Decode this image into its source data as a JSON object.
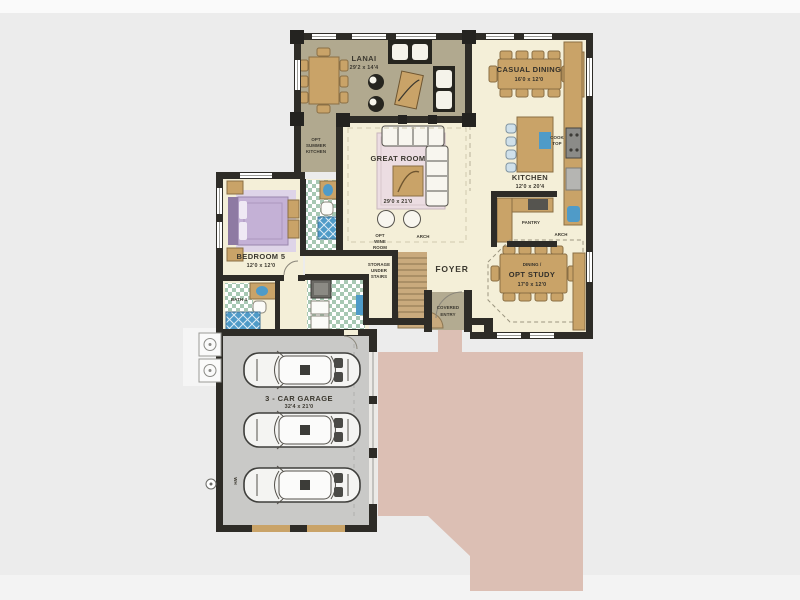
{
  "plan_title": "Single-story home floor plan",
  "rooms": {
    "lanai": {
      "name": "LANAI",
      "dims": "29'2 x 14'4"
    },
    "casual_dining": {
      "name": "CASUAL DINING",
      "dims": "16'0 x 12'0"
    },
    "kitchen": {
      "name": "KITCHEN",
      "dims": "12'0 x 20'4"
    },
    "great_room": {
      "name": "GREAT ROOM",
      "dims": "29'0 x 21'0"
    },
    "bedroom5": {
      "name": "BEDROOM 5",
      "dims": "12'0 x 12'0"
    },
    "bath4": {
      "name": "BATH 4"
    },
    "foyer": {
      "name": "FOYER"
    },
    "dining_opt_study": {
      "line1": "DINING /",
      "line2": "OPT STUDY",
      "dims": "17'0 x 12'0"
    },
    "covered_entry": {
      "line1": "COVERED",
      "line2": "ENTRY"
    },
    "garage": {
      "name": "3 - CAR GARAGE",
      "dims": "32'4 x 21'0"
    }
  },
  "annotations": {
    "opt_summer_kitchen": {
      "line1": "OPT",
      "line2": "SUMMER",
      "line3": "KITCHEN"
    },
    "opt_wine_room": {
      "line1": "OPT",
      "line2": "WINE",
      "line3": "ROOM"
    },
    "storage_under_stairs": {
      "line1": "STORAGE",
      "line2": "UNDER",
      "line3": "STAIRS"
    },
    "pantry": "PANTRY",
    "cook_top": {
      "line1": "COOK",
      "line2": "TOP"
    },
    "arch": "ARCH",
    "wh": "WH"
  },
  "palette": {
    "background": "#ececec",
    "wall": "#2e2c27",
    "lanai_floor": "#b1a98f",
    "interior_floor": "#f4efd8",
    "garage_floor": "#c9c9c7",
    "driveway_pink": "#dcbfb4",
    "wood_tan": "#c9a368",
    "tile_green": "#a7c8b3",
    "water_blue": "#4f9bc8",
    "bed_lavender": "#c4b1d6",
    "rug_pink": "#ecdde2",
    "stairs_tan": "#c9aa7d"
  }
}
